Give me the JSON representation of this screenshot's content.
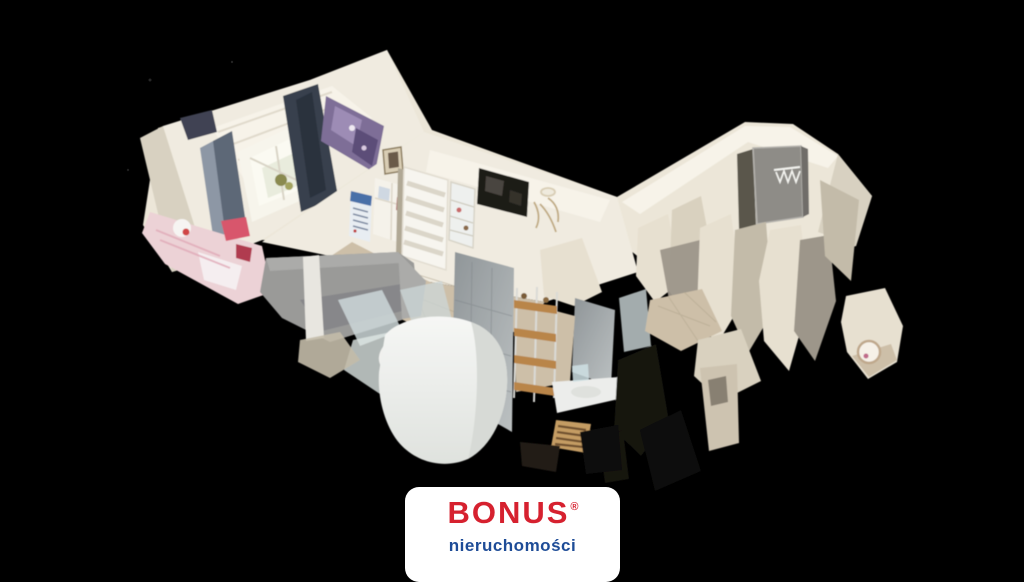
{
  "page": {
    "background": "#000000",
    "width": 1024,
    "height": 576,
    "kind": "real-estate 3d dollhouse tour still"
  },
  "scene": {
    "description": "Cutaway top-down 3D scan (dollhouse view) of an apartment floating on a black background, with torn-mesh scan artifacts",
    "rooms": [
      {
        "name": "bedroom",
        "features": [
          "attic window with daylight",
          "slate-blue curtains",
          "dark navy drape",
          "purple wall art",
          "pink and red bedding"
        ]
      },
      {
        "name": "living-room",
        "features": [
          "grey sofa seen from behind",
          "white slatted interior door",
          "wall-mounted dark tv",
          "wall calendar",
          "white cabinet",
          "glass display cabinet",
          "portrait picture frame",
          "antler wall decor",
          "white chair"
        ]
      },
      {
        "name": "bathroom",
        "features": [
          "grey wall tiles",
          "white bathtub",
          "metal rack with wooden shelves",
          "washbasin counter",
          "tan radiator"
        ]
      },
      {
        "name": "entrance-hall",
        "features": [
          "grey front door",
          "white coat hooks",
          "beige tiled floor",
          "fragmented cream wall pieces",
          "floating wall fragment with round mirror"
        ]
      }
    ],
    "palette": {
      "walls": "#f0ebe0",
      "wall_shadow": "#d8d1c1",
      "floor": "#cdbfa8",
      "tiles": "#9aa0a3",
      "sofa": "#9a9a98",
      "bedding": "#ecd2d6",
      "curtains": "#39424f",
      "background": "#000000"
    }
  },
  "watermark": {
    "brand": "BONUS",
    "registered_mark": "®",
    "subtitle": "nieruchomości",
    "brand_color": "#d6212f",
    "subtitle_color": "#1e4c97",
    "card_background": "#ffffff"
  }
}
